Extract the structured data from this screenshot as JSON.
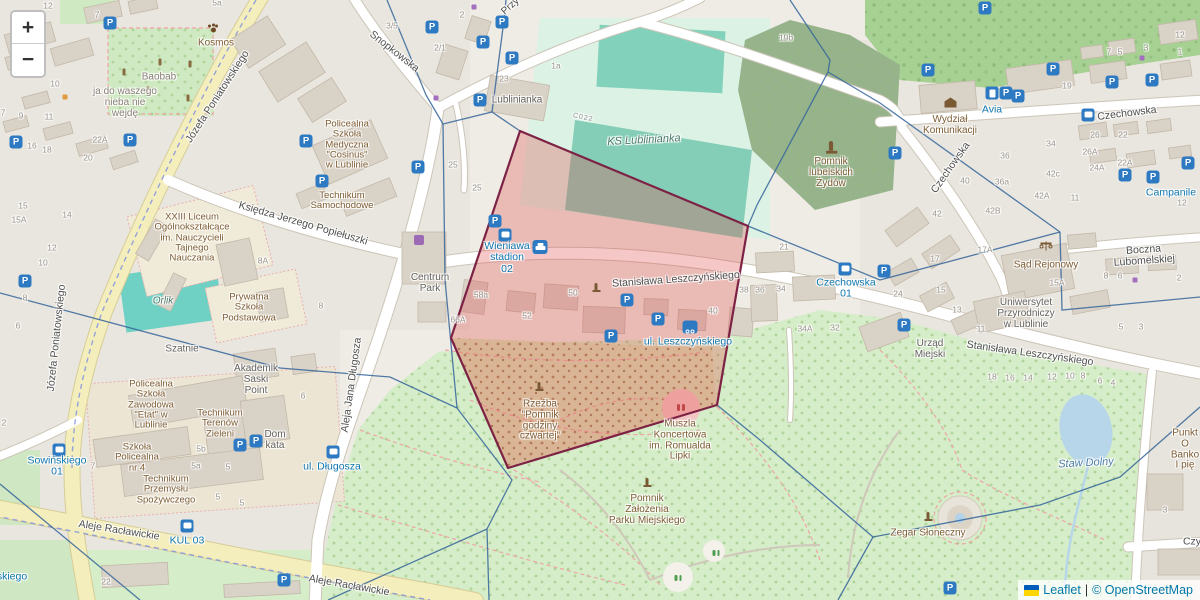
{
  "controls": {
    "zoom_in": "+",
    "zoom_out": "−"
  },
  "attribution": {
    "leaflet": "Leaflet",
    "separator": "|",
    "osm": "© OpenStreetMap",
    "flag_top": "#005BBB",
    "flag_bottom": "#FFD500"
  },
  "palette": {
    "highlight_fill": "#e05252",
    "highlight_stroke": "#7d2244",
    "network_line": "#35659a",
    "transit_blue": "#1077b0",
    "road_yellow": "#f4eebd",
    "park_green": "#d5edc8",
    "pitch_teal": "#84cdb6",
    "forest_green": "#a6d193",
    "water_blue": "#b8d6ea",
    "building_grey": "#d9d2c7"
  },
  "overlays": {
    "highlight": {
      "name": "selected-area",
      "points": "520,131 748,226 717,405 508,468 451,338",
      "fill": "#e05252",
      "fill_opacity": 0.32,
      "stroke": "#7d2244",
      "stroke_width": 2.2
    },
    "network": {
      "color": "#35659a",
      "width": 1.3,
      "opacity": 0.85,
      "paths": [
        "M387,0 L426,95 L443,124",
        "M443,124 L492,112 L520,131",
        "M492,112 L504,20 L506,0",
        "M443,124 L445,280 L457,408",
        "M0,293 L280,368 L390,377 L457,408",
        "M457,408 L512,480 L487,529",
        "M487,529 L489,600",
        "M487,529 L328,600",
        "M0,484 L140,600",
        "M790,0 L830,60 L828,72 L757,205 L748,226",
        "M828,72 L880,103 L1060,232",
        "M748,226 L880,280 L1060,232",
        "M1060,232 L1062,310 L1200,297",
        "M717,405 L760,440 L873,537",
        "M873,537 L1040,505 L1120,477 L1200,407",
        "M873,537 L838,600"
      ]
    }
  },
  "labels": [
    {
      "t": "Józefa Poniatowskiego",
      "x": 218,
      "y": 97,
      "r": -57,
      "c": "street"
    },
    {
      "t": "Józefa Poniatowskiego",
      "x": 57,
      "y": 338,
      "r": -84,
      "c": "street"
    },
    {
      "t": "Snopkowska",
      "x": 394,
      "y": 52,
      "r": 38,
      "c": "street"
    },
    {
      "t": "Księdza Jerzego Popiełuszki",
      "x": 303,
      "y": 224,
      "r": 16,
      "c": "street"
    },
    {
      "t": "Stanisława Leszczyńskiego",
      "x": 676,
      "y": 280,
      "r": -4,
      "c": "street"
    },
    {
      "t": "Stanisława Leszczyńskiego",
      "x": 1030,
      "y": 354,
      "r": 8,
      "c": "street"
    },
    {
      "t": "Czechowska",
      "x": 951,
      "y": 168,
      "r": -55,
      "c": "street"
    },
    {
      "t": "Czechowska",
      "x": 1127,
      "y": 114,
      "r": -7,
      "c": "street"
    },
    {
      "t": "Boczna Lubomelskiej",
      "x": 1144,
      "y": 256,
      "r": -4,
      "c": "street"
    },
    {
      "t": "Aleje Racławickie",
      "x": 119,
      "y": 531,
      "r": 9,
      "c": "street"
    },
    {
      "t": "Aleje Racławickie",
      "x": 349,
      "y": 586,
      "r": 10,
      "c": "street"
    },
    {
      "t": "Aleja Jana Długosza",
      "x": 352,
      "y": 385,
      "r": -82,
      "c": "street"
    },
    {
      "t": "Przy",
      "x": 511,
      "y": 7,
      "r": -42,
      "c": "street",
      "s": 10
    },
    {
      "t": "Czy",
      "x": 1192,
      "y": 542,
      "c": "street"
    },
    {
      "t": "Wieniawa\nstadion\n02",
      "x": 507,
      "y": 258,
      "c": "transit"
    },
    {
      "t": "ul. Leszczyńskiego",
      "x": 688,
      "y": 342,
      "c": "transit"
    },
    {
      "t": "Czechowska\n01",
      "x": 846,
      "y": 289,
      "c": "transit"
    },
    {
      "t": "Sowińskiego\n01",
      "x": 57,
      "y": 467,
      "c": "transit"
    },
    {
      "t": "KUL 03",
      "x": 187,
      "y": 541,
      "c": "transit"
    },
    {
      "t": "Avia",
      "x": 992,
      "y": 110,
      "c": "transit"
    },
    {
      "t": "Campanile",
      "x": 1171,
      "y": 193,
      "c": "transit"
    },
    {
      "t": "ul. Długosza",
      "x": 332,
      "y": 467,
      "c": "transit"
    },
    {
      "t": "skiego",
      "x": 12,
      "y": 577,
      "c": "transit"
    },
    {
      "t": "Staw Dolny",
      "x": 1086,
      "y": 464,
      "r": -3,
      "c": "water"
    },
    {
      "t": "KS Lublinianka",
      "x": 644,
      "y": 141,
      "r": -3,
      "c": "pitch"
    },
    {
      "t": "Orlik",
      "x": 163,
      "y": 302,
      "c": "pitch",
      "s": 10
    },
    {
      "t": "Kosmos",
      "x": 216,
      "y": 44,
      "c": "poi"
    },
    {
      "t": "Baobab",
      "x": 159,
      "y": 78,
      "c": "misc"
    },
    {
      "t": "ja do waszego\nnieba nie\nwejdę",
      "x": 125,
      "y": 103,
      "c": "misc"
    },
    {
      "t": "Policealna\nSzkoła\nMedyczna\n\"Cosinus\"\nw Lublinie",
      "x": 347,
      "y": 145,
      "c": "poi",
      "s": 9.5
    },
    {
      "t": "Technikum\nSamochodowe",
      "x": 342,
      "y": 201,
      "c": "poi",
      "s": 9.5
    },
    {
      "t": "XXIII Liceum\nOgólnokształcące\nim. Nauczycieli\nTajnego\nNauczania",
      "x": 192,
      "y": 238,
      "c": "poi",
      "s": 9.5
    },
    {
      "t": "Prywatna\nSzkoła\nPodstawowa",
      "x": 249,
      "y": 308,
      "c": "poi",
      "s": 9.5
    },
    {
      "t": "Akademik\nSaski\nPoint",
      "x": 256,
      "y": 380,
      "c": "bldg"
    },
    {
      "t": "Centrum\nPark",
      "x": 430,
      "y": 284,
      "c": "bldg"
    },
    {
      "t": "Szatnie",
      "x": 182,
      "y": 350,
      "c": "bldg"
    },
    {
      "t": "Lublinianka",
      "x": 517,
      "y": 101,
      "c": "bldg"
    },
    {
      "t": "Policealna\nSzkoła\nZawodowa\n\"Etat\" w\nLublinie",
      "x": 151,
      "y": 405,
      "c": "poi",
      "s": 9.5
    },
    {
      "t": "Technikum\nTerenów\nZieleni",
      "x": 220,
      "y": 424,
      "c": "poi",
      "s": 9.5
    },
    {
      "t": "Szkoła\nPolicealna\nnr 4",
      "x": 137,
      "y": 458,
      "c": "poi",
      "s": 9.5
    },
    {
      "t": "Technikum\nPrzemysłu\nSpożywczego",
      "x": 166,
      "y": 490,
      "c": "poi",
      "s": 9.5
    },
    {
      "t": "Dom\nkata",
      "x": 275,
      "y": 441,
      "c": "bldg"
    },
    {
      "t": "Pomnik\nlubelskich\nŻydów",
      "x": 831,
      "y": 173,
      "c": "poi"
    },
    {
      "t": "Wydział\nKomunikacji",
      "x": 950,
      "y": 126,
      "c": "poi"
    },
    {
      "t": "Rzeźba\n\"Pomnik\ngodziny\nczwartej\"",
      "x": 540,
      "y": 421,
      "c": "poi"
    },
    {
      "t": "Muszla\nKoncertowa\nim. Romualda\nLipki",
      "x": 680,
      "y": 441,
      "c": "poi"
    },
    {
      "t": "Pomnik\nZałożenia\nParku Miejskiego",
      "x": 647,
      "y": 510,
      "c": "poi"
    },
    {
      "t": "Zegar Słoneczny",
      "x": 928,
      "y": 534,
      "c": "poi"
    },
    {
      "t": "Urząd\nMiejski",
      "x": 930,
      "y": 350,
      "c": "bldg"
    },
    {
      "t": "Uniwersytet\nPrzyrodniczy\nw Lublinie",
      "x": 1026,
      "y": 314,
      "c": "bldg"
    },
    {
      "t": "Sąd Rejonowy",
      "x": 1046,
      "y": 266,
      "c": "poi"
    },
    {
      "t": "Punkt O\nBanko\nI pię",
      "x": 1185,
      "y": 450,
      "c": "poi"
    },
    {
      "t": "C022",
      "x": 583,
      "y": 118,
      "r": 12,
      "c": "ref"
    },
    {
      "t": "12",
      "x": 48,
      "y": 6,
      "c": "num"
    },
    {
      "t": "7",
      "x": 97,
      "y": 15,
      "c": "num"
    },
    {
      "t": "5a",
      "x": 217,
      "y": 3,
      "c": "num"
    },
    {
      "t": "3/5",
      "x": 392,
      "y": 26,
      "c": "num"
    },
    {
      "t": "2",
      "x": 462,
      "y": 15,
      "c": "num"
    },
    {
      "t": "2/1",
      "x": 440,
      "y": 48,
      "c": "num"
    },
    {
      "t": "23",
      "x": 504,
      "y": 79,
      "c": "num"
    },
    {
      "t": "1a",
      "x": 556,
      "y": 66,
      "c": "num"
    },
    {
      "t": "19b",
      "x": 786,
      "y": 38,
      "c": "num"
    },
    {
      "t": "10",
      "x": 55,
      "y": 84,
      "c": "num"
    },
    {
      "t": "9",
      "x": 21,
      "y": 116,
      "c": "num"
    },
    {
      "t": "7",
      "x": 3,
      "y": 113,
      "c": "num"
    },
    {
      "t": "11",
      "x": 49,
      "y": 117,
      "c": "num"
    },
    {
      "t": "22A",
      "x": 100,
      "y": 140,
      "c": "num"
    },
    {
      "t": "16",
      "x": 32,
      "y": 146,
      "c": "num"
    },
    {
      "t": "18",
      "x": 47,
      "y": 150,
      "c": "num"
    },
    {
      "t": "20",
      "x": 88,
      "y": 158,
      "c": "num"
    },
    {
      "t": "15",
      "x": 23,
      "y": 206,
      "c": "num"
    },
    {
      "t": "15A",
      "x": 19,
      "y": 220,
      "c": "num"
    },
    {
      "t": "14",
      "x": 67,
      "y": 215,
      "c": "num"
    },
    {
      "t": "12",
      "x": 52,
      "y": 248,
      "c": "num"
    },
    {
      "t": "10",
      "x": 43,
      "y": 263,
      "c": "num"
    },
    {
      "t": "8",
      "x": 25,
      "y": 298,
      "c": "num"
    },
    {
      "t": "6",
      "x": 18,
      "y": 326,
      "c": "num"
    },
    {
      "t": "8",
      "x": 321,
      "y": 306,
      "c": "num"
    },
    {
      "t": "6",
      "x": 303,
      "y": 396,
      "c": "num"
    },
    {
      "t": "8A",
      "x": 263,
      "y": 261,
      "c": "num"
    },
    {
      "t": "2",
      "x": 4,
      "y": 423,
      "c": "num"
    },
    {
      "t": "22",
      "x": 106,
      "y": 582,
      "c": "num"
    },
    {
      "t": "25",
      "x": 453,
      "y": 165,
      "c": "num"
    },
    {
      "t": "25",
      "x": 477,
      "y": 188,
      "c": "num"
    },
    {
      "t": "7",
      "x": 93,
      "y": 466,
      "c": "num"
    },
    {
      "t": "5b",
      "x": 201,
      "y": 449,
      "c": "num"
    },
    {
      "t": "5a",
      "x": 196,
      "y": 466,
      "c": "num"
    },
    {
      "t": "5",
      "x": 228,
      "y": 467,
      "c": "num"
    },
    {
      "t": "5",
      "x": 218,
      "y": 497,
      "c": "num"
    },
    {
      "t": "5",
      "x": 242,
      "y": 503,
      "c": "num"
    },
    {
      "t": "50",
      "x": 573,
      "y": 293,
      "c": "num"
    },
    {
      "t": "52",
      "x": 527,
      "y": 316,
      "c": "num"
    },
    {
      "t": "58a",
      "x": 481,
      "y": 295,
      "c": "num"
    },
    {
      "t": "66A",
      "x": 458,
      "y": 320,
      "c": "num"
    },
    {
      "t": "40",
      "x": 713,
      "y": 311,
      "c": "num"
    },
    {
      "t": "19",
      "x": 1067,
      "y": 86,
      "c": "num"
    },
    {
      "t": "26",
      "x": 1095,
      "y": 135,
      "c": "num"
    },
    {
      "t": "26A",
      "x": 1090,
      "y": 152,
      "c": "num"
    },
    {
      "t": "22",
      "x": 1123,
      "y": 135,
      "c": "num"
    },
    {
      "t": "22A",
      "x": 1125,
      "y": 163,
      "c": "num"
    },
    {
      "t": "24A",
      "x": 1097,
      "y": 168,
      "c": "num"
    },
    {
      "t": "34",
      "x": 1051,
      "y": 144,
      "c": "num"
    },
    {
      "t": "36",
      "x": 1005,
      "y": 156,
      "c": "num"
    },
    {
      "t": "36a",
      "x": 1002,
      "y": 182,
      "c": "num"
    },
    {
      "t": "40",
      "x": 965,
      "y": 181,
      "c": "num"
    },
    {
      "t": "42",
      "x": 937,
      "y": 214,
      "c": "num"
    },
    {
      "t": "42A",
      "x": 1042,
      "y": 196,
      "c": "num"
    },
    {
      "t": "42B",
      "x": 993,
      "y": 211,
      "c": "num"
    },
    {
      "t": "42c",
      "x": 1053,
      "y": 174,
      "c": "num"
    },
    {
      "t": "11",
      "x": 1075,
      "y": 198,
      "c": "num"
    },
    {
      "t": "12",
      "x": 1182,
      "y": 203,
      "c": "num"
    },
    {
      "t": "7",
      "x": 1109,
      "y": 52,
      "c": "num"
    },
    {
      "t": "5",
      "x": 1120,
      "y": 52,
      "c": "num"
    },
    {
      "t": "3",
      "x": 1146,
      "y": 48,
      "c": "num"
    },
    {
      "t": "12",
      "x": 1180,
      "y": 35,
      "c": "num"
    },
    {
      "t": "1",
      "x": 1180,
      "y": 52,
      "c": "num"
    },
    {
      "t": "8",
      "x": 1106,
      "y": 276,
      "c": "num"
    },
    {
      "t": "6",
      "x": 1120,
      "y": 276,
      "c": "num"
    },
    {
      "t": "2",
      "x": 1179,
      "y": 278,
      "c": "num"
    },
    {
      "t": "15A",
      "x": 1057,
      "y": 283,
      "c": "num"
    },
    {
      "t": "17A",
      "x": 985,
      "y": 250,
      "c": "num"
    },
    {
      "t": "17",
      "x": 935,
      "y": 259,
      "c": "num"
    },
    {
      "t": "15",
      "x": 941,
      "y": 290,
      "c": "num"
    },
    {
      "t": "13",
      "x": 957,
      "y": 310,
      "c": "num"
    },
    {
      "t": "11",
      "x": 981,
      "y": 329,
      "c": "num"
    },
    {
      "t": "24",
      "x": 898,
      "y": 294,
      "c": "num"
    },
    {
      "t": "21",
      "x": 784,
      "y": 247,
      "c": "num"
    },
    {
      "t": "38",
      "x": 744,
      "y": 290,
      "c": "num"
    },
    {
      "t": "36",
      "x": 760,
      "y": 290,
      "c": "num"
    },
    {
      "t": "34",
      "x": 781,
      "y": 289,
      "c": "num"
    },
    {
      "t": "34A",
      "x": 805,
      "y": 329,
      "c": "num"
    },
    {
      "t": "32",
      "x": 835,
      "y": 328,
      "c": "num"
    },
    {
      "t": "18",
      "x": 992,
      "y": 377,
      "c": "num"
    },
    {
      "t": "16",
      "x": 1010,
      "y": 378,
      "c": "num"
    },
    {
      "t": "14",
      "x": 1028,
      "y": 378,
      "c": "num"
    },
    {
      "t": "12",
      "x": 1052,
      "y": 377,
      "c": "num"
    },
    {
      "t": "10",
      "x": 1070,
      "y": 376,
      "c": "num"
    },
    {
      "t": "8",
      "x": 1083,
      "y": 376,
      "c": "num"
    },
    {
      "t": "6",
      "x": 1100,
      "y": 381,
      "c": "num"
    },
    {
      "t": "4",
      "x": 1113,
      "y": 383,
      "c": "num"
    },
    {
      "t": "5",
      "x": 1121,
      "y": 327,
      "c": "num"
    },
    {
      "t": "3",
      "x": 1141,
      "y": 327,
      "c": "num"
    },
    {
      "t": "3",
      "x": 1165,
      "y": 510,
      "c": "num"
    }
  ],
  "icons": [
    {
      "k": "parking",
      "x": 110,
      "y": 23
    },
    {
      "k": "parking",
      "x": 130,
      "y": 140
    },
    {
      "k": "parking",
      "x": 16,
      "y": 142
    },
    {
      "k": "parking",
      "x": 25,
      "y": 281
    },
    {
      "k": "parking",
      "x": 432,
      "y": 27
    },
    {
      "k": "parking",
      "x": 483,
      "y": 42
    },
    {
      "k": "parking",
      "x": 502,
      "y": 22
    },
    {
      "k": "parking",
      "x": 512,
      "y": 58
    },
    {
      "k": "parking",
      "x": 480,
      "y": 100
    },
    {
      "k": "parking",
      "x": 418,
      "y": 167
    },
    {
      "k": "parking",
      "x": 306,
      "y": 141
    },
    {
      "k": "parking",
      "x": 322,
      "y": 181
    },
    {
      "k": "parking",
      "x": 495,
      "y": 221
    },
    {
      "k": "parking",
      "x": 627,
      "y": 300
    },
    {
      "k": "parking",
      "x": 658,
      "y": 319
    },
    {
      "k": "parking",
      "x": 611,
      "y": 336
    },
    {
      "k": "parking",
      "x": 884,
      "y": 271
    },
    {
      "k": "parking",
      "x": 904,
      "y": 325
    },
    {
      "k": "parking",
      "x": 1053,
      "y": 69
    },
    {
      "k": "parking",
      "x": 1006,
      "y": 93
    },
    {
      "k": "parking",
      "x": 1018,
      "y": 96
    },
    {
      "k": "parking",
      "x": 1112,
      "y": 82
    },
    {
      "k": "parking",
      "x": 1152,
      "y": 80
    },
    {
      "k": "parking",
      "x": 895,
      "y": 153
    },
    {
      "k": "parking",
      "x": 928,
      "y": 70
    },
    {
      "k": "parking",
      "x": 1125,
      "y": 175
    },
    {
      "k": "parking",
      "x": 1153,
      "y": 177
    },
    {
      "k": "parking",
      "x": 1188,
      "y": 163
    },
    {
      "k": "parking",
      "x": 240,
      "y": 445
    },
    {
      "k": "parking",
      "x": 256,
      "y": 441
    },
    {
      "k": "parking",
      "x": 950,
      "y": 588
    },
    {
      "k": "parking",
      "x": 985,
      "y": 8
    },
    {
      "k": "parking",
      "x": 284,
      "y": 580
    },
    {
      "k": "bus",
      "x": 505,
      "y": 235
    },
    {
      "k": "bus",
      "x": 845,
      "y": 269
    },
    {
      "k": "bus",
      "x": 59,
      "y": 450
    },
    {
      "k": "bus",
      "x": 187,
      "y": 526
    },
    {
      "k": "bus",
      "x": 333,
      "y": 452
    },
    {
      "k": "bus",
      "x": 1088,
      "y": 115
    },
    {
      "k": "taxi",
      "x": 540,
      "y": 247
    },
    {
      "k": "fuel",
      "x": 992,
      "y": 93
    },
    {
      "k": "bike",
      "x": 690,
      "y": 327
    },
    {
      "k": "shop",
      "x": 419,
      "y": 240
    },
    {
      "k": "monument",
      "x": 596,
      "y": 288
    },
    {
      "k": "monument",
      "x": 539,
      "y": 387
    },
    {
      "k": "monument",
      "x": 647,
      "y": 483
    },
    {
      "k": "monument",
      "x": 928,
      "y": 517
    },
    {
      "k": "monument-lg",
      "x": 831,
      "y": 148
    },
    {
      "k": "museum",
      "x": 950,
      "y": 103
    },
    {
      "k": "scales",
      "x": 1046,
      "y": 246
    },
    {
      "k": "paw",
      "x": 213,
      "y": 29
    },
    {
      "k": "theater",
      "x": 681,
      "y": 407
    },
    {
      "k": "playground",
      "x": 678,
      "y": 577
    },
    {
      "k": "playground",
      "x": 716,
      "y": 552
    },
    {
      "k": "bollard",
      "x": 124,
      "y": 72
    },
    {
      "k": "bollard",
      "x": 160,
      "y": 62
    },
    {
      "k": "bollard",
      "x": 190,
      "y": 64
    },
    {
      "k": "bollard",
      "x": 188,
      "y": 98
    },
    {
      "k": "bollard",
      "x": 148,
      "y": 90
    },
    {
      "k": "dot-purple",
      "x": 474,
      "y": 7
    },
    {
      "k": "dot-purple",
      "x": 436,
      "y": 98
    },
    {
      "k": "dot-purple",
      "x": 1142,
      "y": 58
    },
    {
      "k": "dot-purple",
      "x": 1135,
      "y": 280
    },
    {
      "k": "dot-orange",
      "x": 65,
      "y": 97
    }
  ]
}
